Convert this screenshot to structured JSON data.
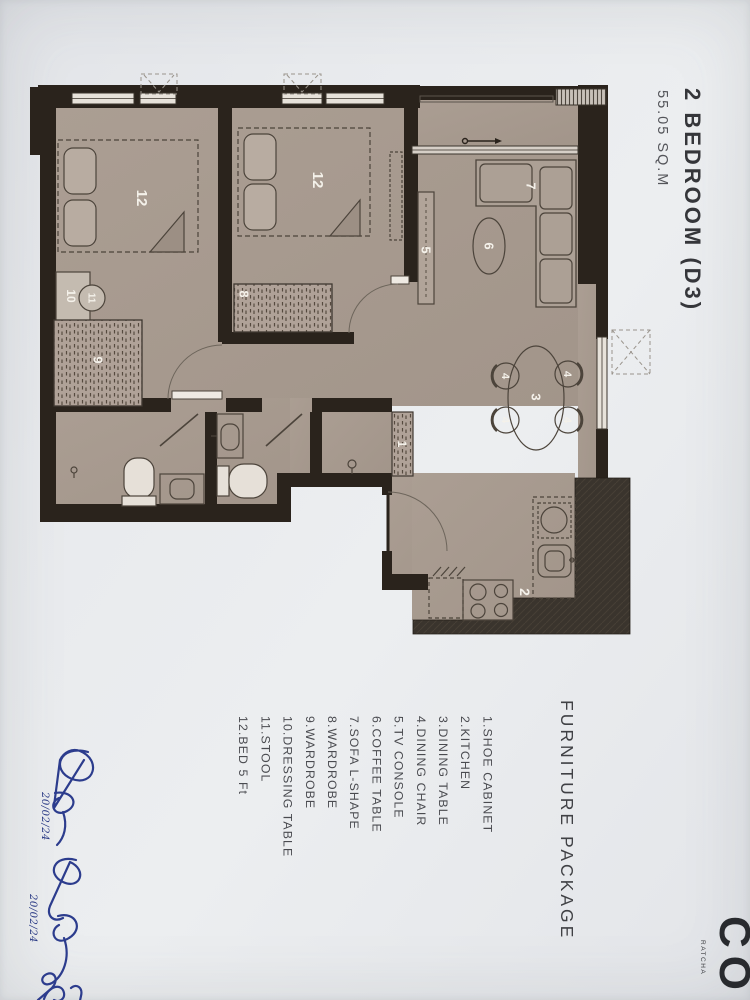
{
  "document": {
    "title": "2 BEDROOM (D3)",
    "area": "55.05 SQ.M"
  },
  "furniture_package": {
    "heading": "FURNITURE PACKAGE",
    "items": [
      "1.SHOE CABINET",
      "2.KITCHEN",
      "3.DINING TABLE",
      "4.DINING CHAIR",
      "5.TV CONSOLE",
      "6.COFFEE TABLE",
      "7.SOFA L-SHAPE",
      "8.WARDROBE",
      "9.WARDROBE",
      "10.DRESSING TABLE",
      "11.STOOL",
      "12.BED 5 Ft"
    ]
  },
  "plan": {
    "labels": {
      "bed": "12",
      "tv_console": "5",
      "coffee_table": "6",
      "sofa": "7",
      "dining_table": "3",
      "dining_chair": "4",
      "shoe_cabinet": "1",
      "kitchen": "2",
      "wardrobe_8": "8",
      "wardrobe_9": "9",
      "dressing_table": "10",
      "stool": "11"
    }
  },
  "annotations": {
    "signature_dates": [
      "20/02/24",
      "20/02/24"
    ]
  },
  "logo": {
    "mark": "CO",
    "subtext": "RATCHA"
  }
}
